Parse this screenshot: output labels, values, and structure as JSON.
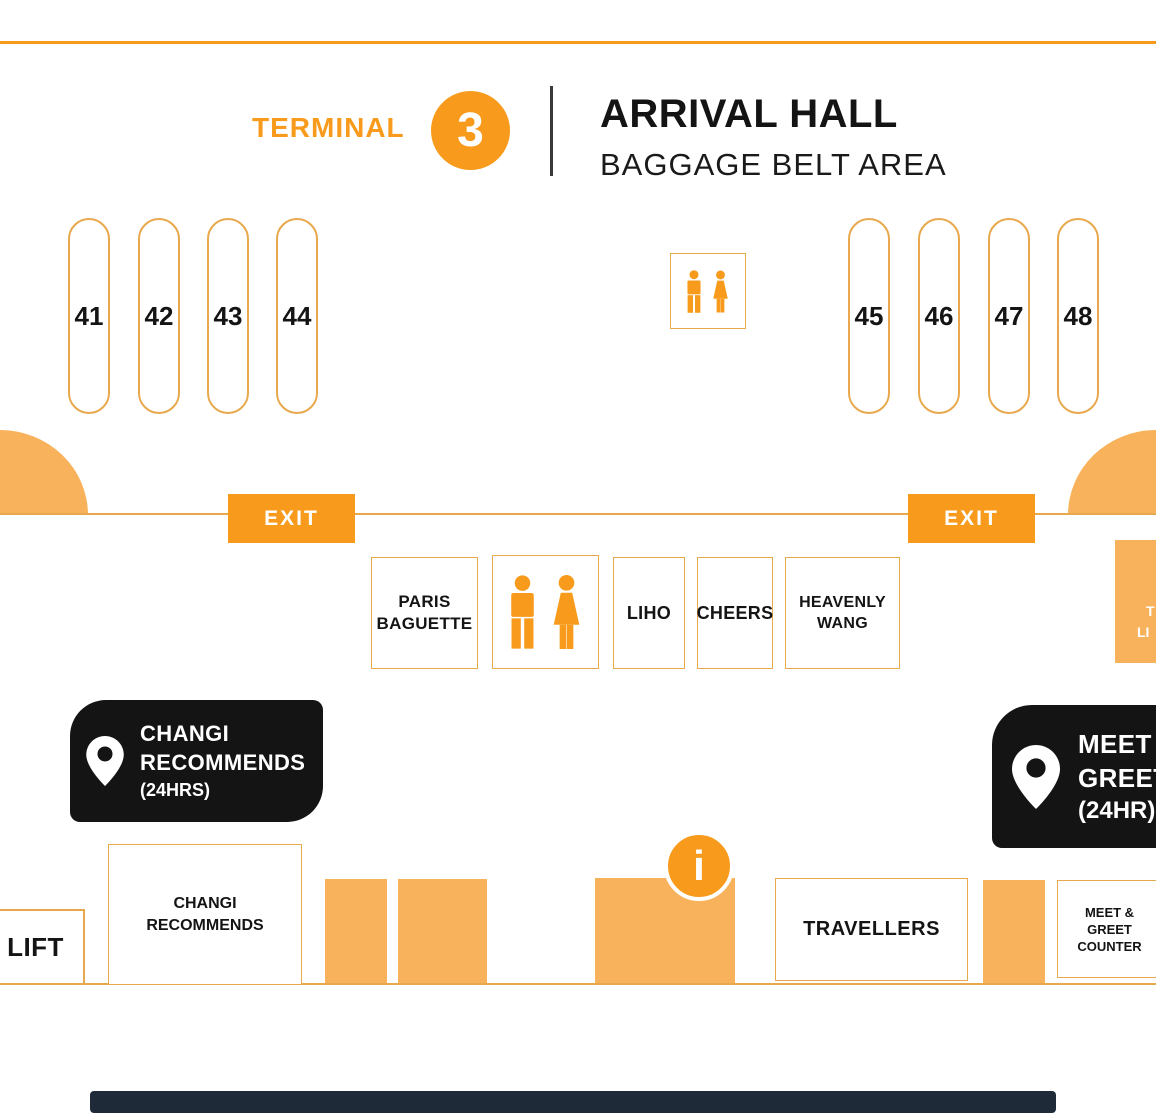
{
  "header": {
    "terminal_label": "TERMINAL",
    "terminal_number": "3",
    "title": "ARRIVAL HALL",
    "subtitle": "BAGGAGE BELT AREA"
  },
  "belts": {
    "left": [
      "41",
      "42",
      "43",
      "44"
    ],
    "right": [
      "45",
      "46",
      "47",
      "48"
    ]
  },
  "signs": {
    "exit_left": "EXIT",
    "exit_right": "EXIT"
  },
  "shops": {
    "paris_baguette": {
      "line1": "PARIS",
      "line2": "BAGUETTE"
    },
    "liho": "LIHO",
    "cheers": "CHEERS",
    "heavenly_wang": {
      "line1": "HEAVENLY",
      "line2": "WANG"
    }
  },
  "badges": {
    "changi_recommends": {
      "line1": "CHANGI",
      "line2": "RECOMMENDS",
      "line3": "(24HRS)"
    },
    "meet_greet": {
      "line1": "MEET",
      "line2": "GREET",
      "line3": "(24HR)"
    }
  },
  "counters": {
    "lift": "LIFT",
    "changi_recommends": {
      "line1": "CHANGI",
      "line2": "RECOMMENDS"
    },
    "travellers": "TRAVELLERS",
    "meet_greet_counter": {
      "line1": "MEET &",
      "line2": "GREET",
      "line3": "COUNTER"
    }
  },
  "partial_right_label": {
    "line1": "T",
    "line2": "LI"
  },
  "info_glyph": "i",
  "icons": {
    "info": "info-icon",
    "toilet_male": "male-icon",
    "toilet_female": "female-icon",
    "location_pin": "location-pin-icon",
    "terminal_number_disc": "terminal-3-disc"
  },
  "colors": {
    "orange": "#F89B1C",
    "light_orange": "#F9B25C",
    "outline_orange": "#E8A94E",
    "black": "#141414",
    "navy": "#1E2A38",
    "white": "#FFFFFF"
  }
}
